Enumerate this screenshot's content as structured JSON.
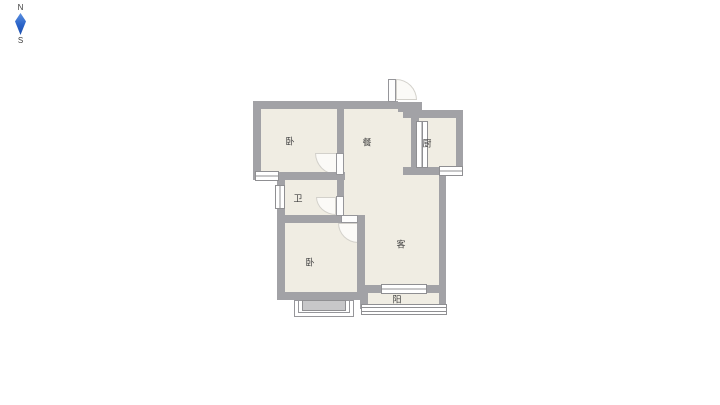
{
  "compass": {
    "north": "N",
    "south": "S"
  },
  "floorplan": {
    "rooms": [
      {
        "id": "bedroom-1",
        "label": "卧",
        "x": 290,
        "y": 141
      },
      {
        "id": "dining",
        "label": "餐",
        "x": 367,
        "y": 142
      },
      {
        "id": "kitchen",
        "label": "厨",
        "x": 427,
        "y": 143
      },
      {
        "id": "bathroom",
        "label": "卫",
        "x": 298,
        "y": 198
      },
      {
        "id": "bedroom-2",
        "label": "卧",
        "x": 310,
        "y": 262
      },
      {
        "id": "living",
        "label": "客",
        "x": 401,
        "y": 244
      },
      {
        "id": "balcony",
        "label": "阳",
        "x": 397,
        "y": 299
      }
    ],
    "colors": {
      "wall": "#a2a2a6",
      "floor": "#f0ede3",
      "compass_needle": "#2a63c8"
    }
  }
}
